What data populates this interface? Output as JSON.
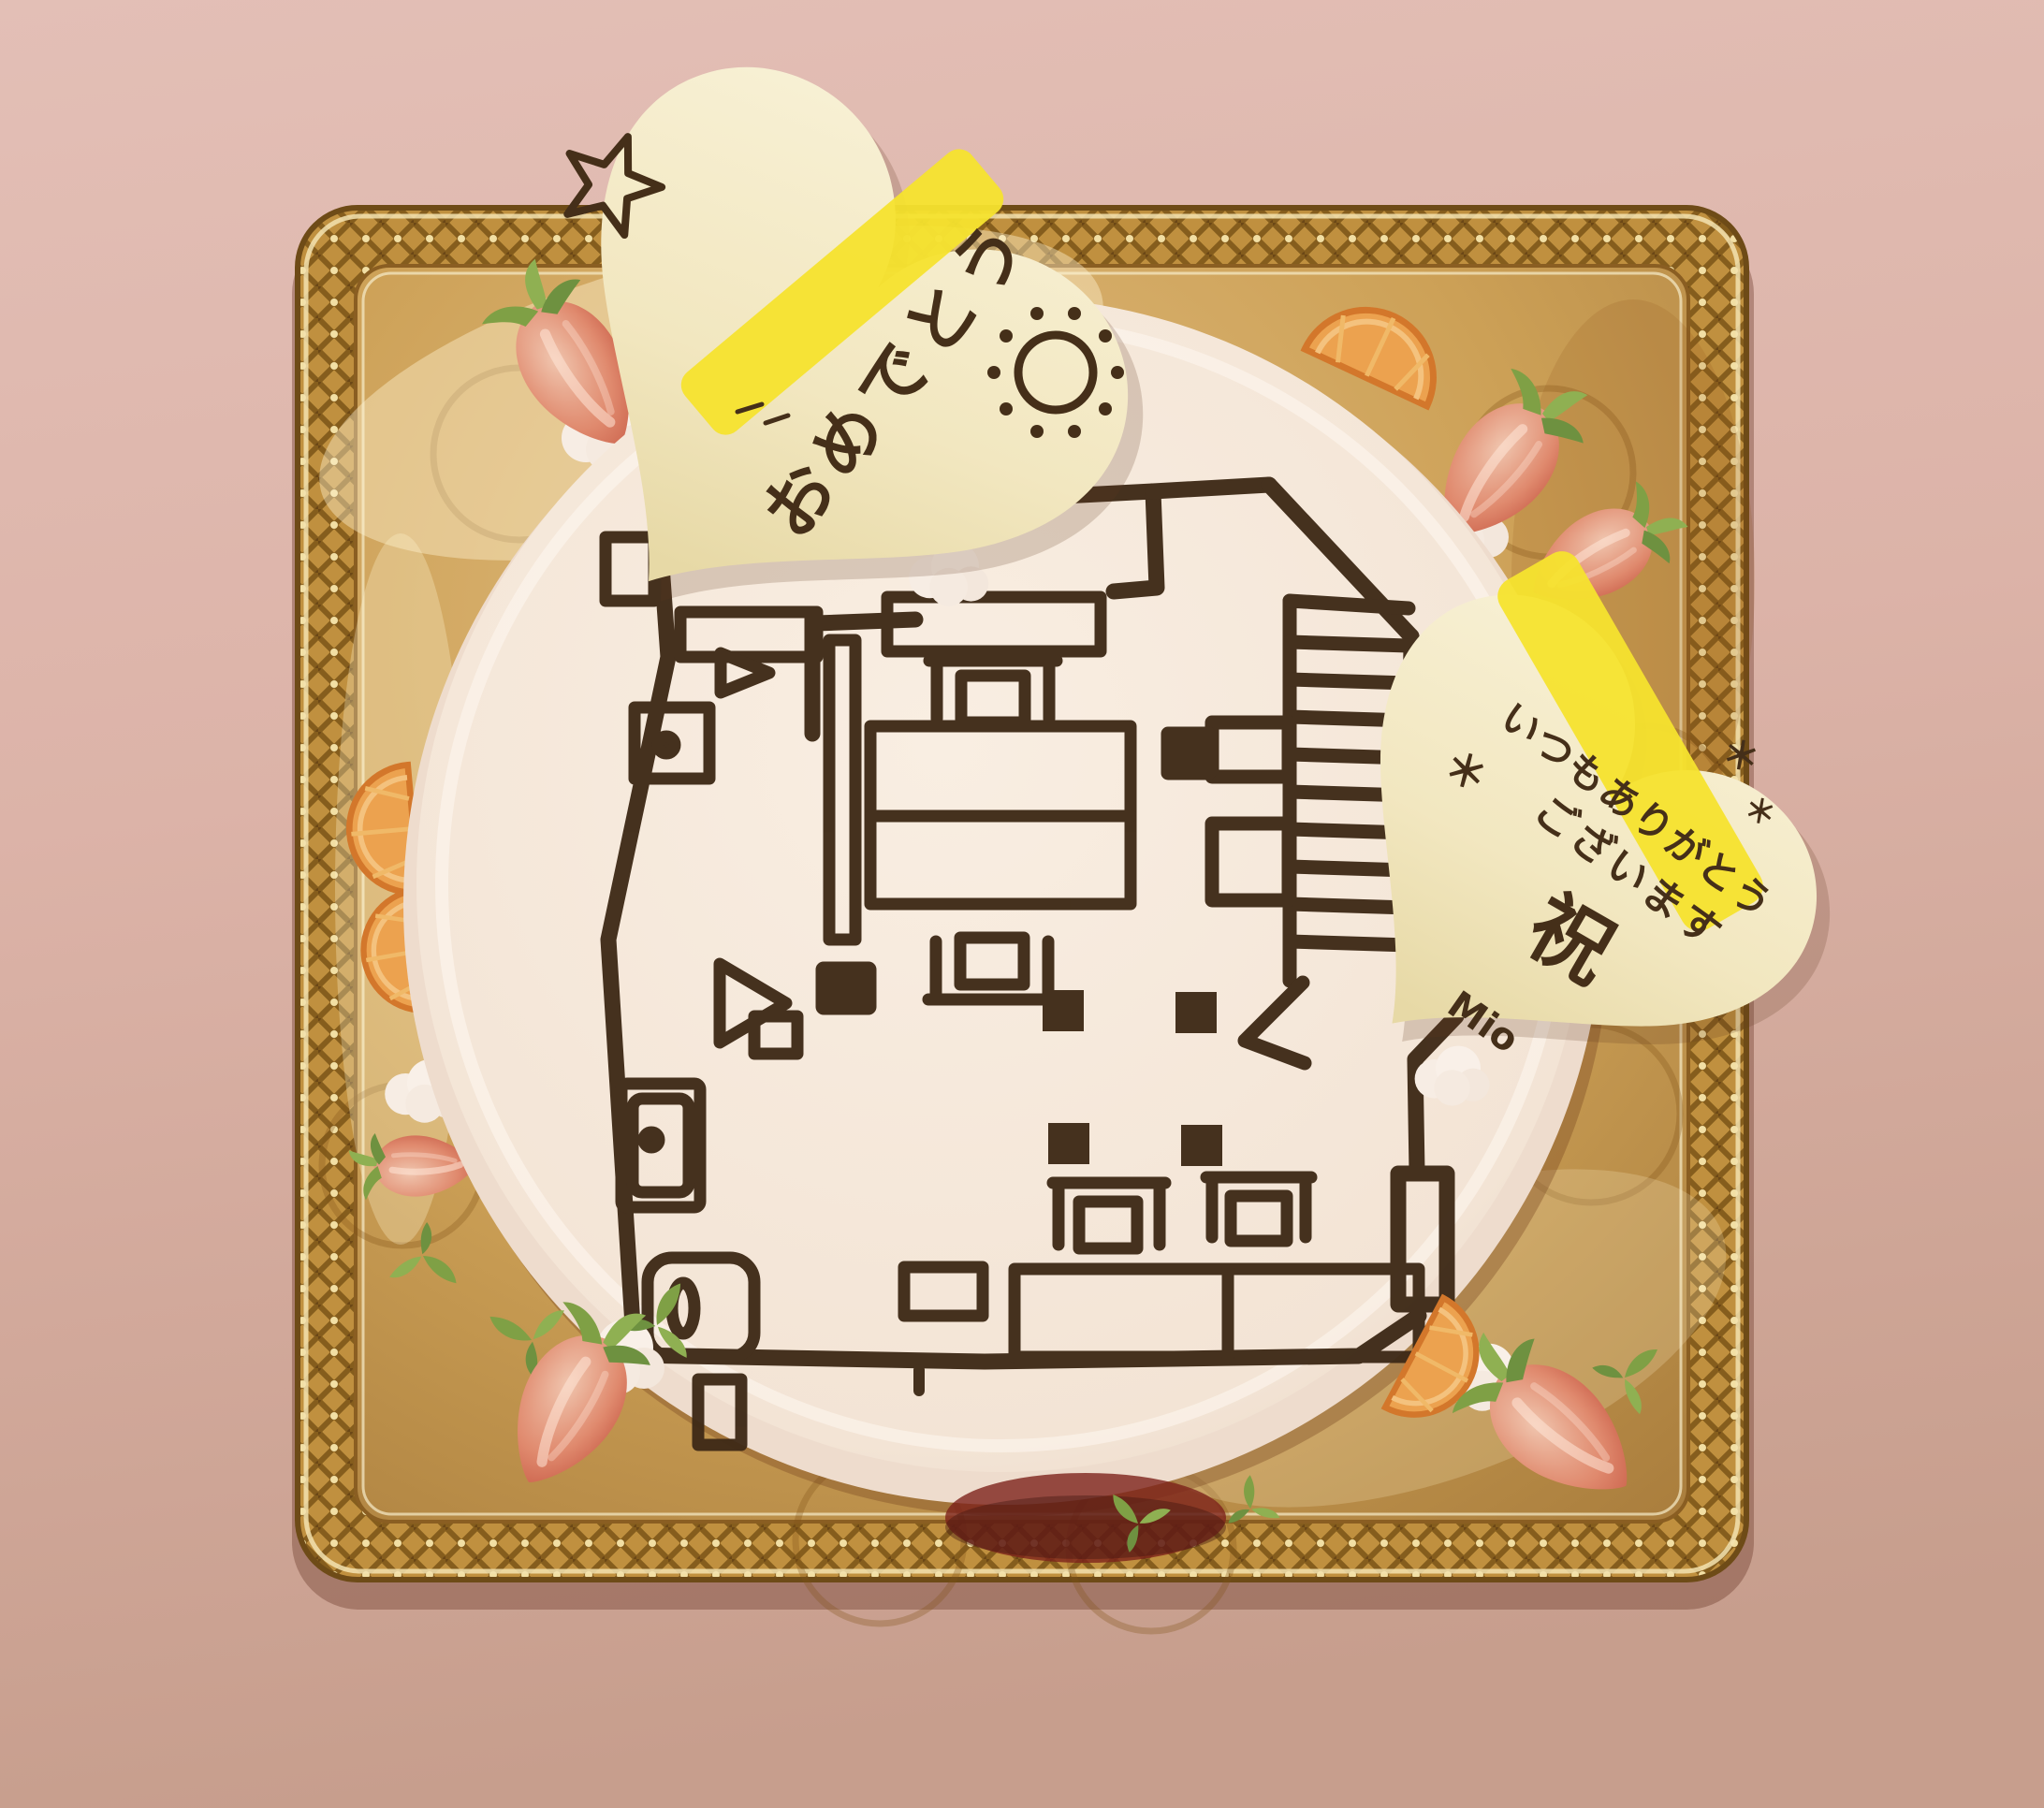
{
  "scene": {
    "subject": "round white cream cake decorated with a hand-piped chocolate floor plan, on a gold tray with strawberries and orange slices, two white-chocolate heart plaques with handwritten messages"
  },
  "hearts": {
    "top": {
      "message": "おめでとう",
      "decorations": [
        "star-doodle",
        "yellow-censor-stripe",
        "sun-doodle"
      ]
    },
    "right": {
      "line1": "いつもありがとう",
      "line2": "ございます",
      "stamp": "祝",
      "signature": "Mio",
      "mark_left": "＊",
      "mark_right_a": "＊",
      "mark_right_b": "＊",
      "decorations": [
        "yellow-censor-stripe"
      ]
    }
  },
  "colors": {
    "background_top": "#e2bdb4",
    "background_bottom": "#c79e8d",
    "tray_gold": "#c8994e",
    "tray_gold_dark": "#7c5a1e",
    "tray_gold_light": "#f2e0a8",
    "cake_cream": "#f6e9dd",
    "chocolate": "#3e2a17",
    "heart_cream": "#f4ebc8",
    "highlight_yellow": "#f6e32e",
    "strawberry_red": "#c94f3d",
    "leaf_green": "#85a84b",
    "orange": "#e9a24e"
  },
  "counts": {
    "strawberries": 8,
    "orange_slices": 4,
    "heart_plaques": 2
  }
}
